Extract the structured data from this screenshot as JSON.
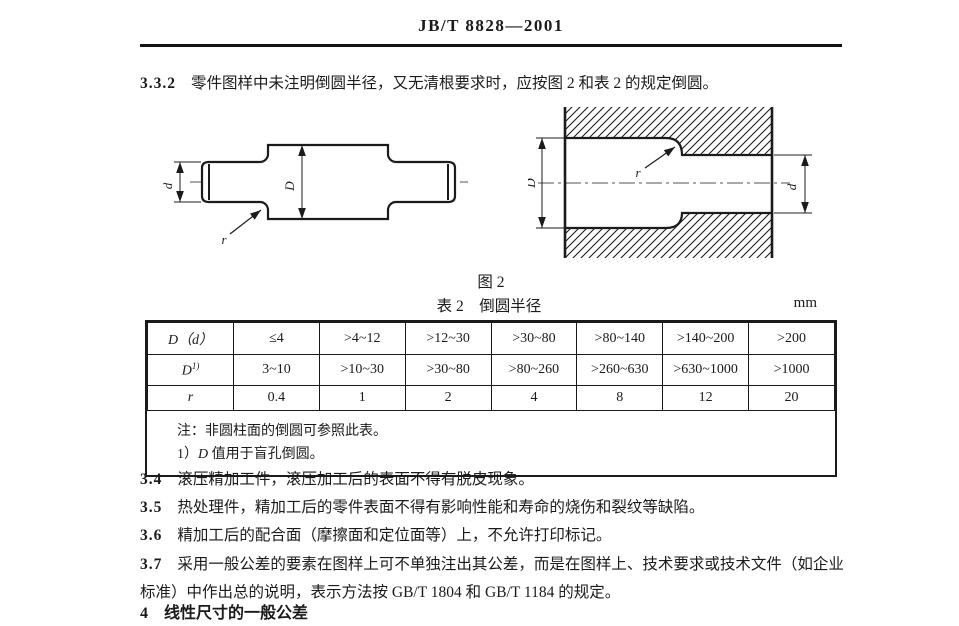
{
  "header": {
    "standard_number": "JB/T 8828—2001"
  },
  "clauses": {
    "c332": {
      "num": "3.3.2",
      "text": "零件图样中未注明倒圆半径，又无清根要求时，应按图 2 和表 2 的规定倒圆。"
    },
    "c34": {
      "num": "3.4",
      "text": "滚压精加工件，滚压加工后的表面不得有脱皮现象。"
    },
    "c35": {
      "num": "3.5",
      "text": "热处理件，精加工后的零件表面不得有影响性能和寿命的烧伤和裂纹等缺陷。"
    },
    "c36": {
      "num": "3.6",
      "text": "精加工后的配合面（摩擦面和定位面等）上，不允许打印标记。"
    },
    "c37": {
      "num": "3.7",
      "text": "采用一般公差的要素在图样上可不单独注出其公差，而是在图样上、技术要求或技术文件（如企业标准）中作出总的说明，表示方法按 GB/T 1804 和 GB/T 1184 的规定。"
    },
    "c4": {
      "num": "4",
      "text": "线性尺寸的一般公差"
    }
  },
  "figure": {
    "caption": "图 2",
    "labels": {
      "small_diameter": "d",
      "large_diameter": "D",
      "radius": "r"
    }
  },
  "table": {
    "caption": "表 2　倒圆半径",
    "unit": "mm",
    "rows": [
      {
        "label": "D（d）",
        "cells": [
          "≤4",
          ">4~12",
          ">12~30",
          ">30~80",
          ">80~140",
          ">140~200",
          ">200"
        ]
      },
      {
        "label_base": "D",
        "label_sup": "1)",
        "cells": [
          "3~10",
          ">10~30",
          ">30~80",
          ">80~260",
          ">260~630",
          ">630~1000",
          ">1000"
        ]
      },
      {
        "label": "r",
        "cells": [
          "0.4",
          "1",
          "2",
          "4",
          "8",
          "12",
          "20"
        ]
      }
    ],
    "note": "注：非圆柱面的倒圆可参照此表。",
    "footnote": {
      "prefix": "1）",
      "symbol": "D",
      "suffix": " 值用于盲孔倒圆。"
    }
  }
}
